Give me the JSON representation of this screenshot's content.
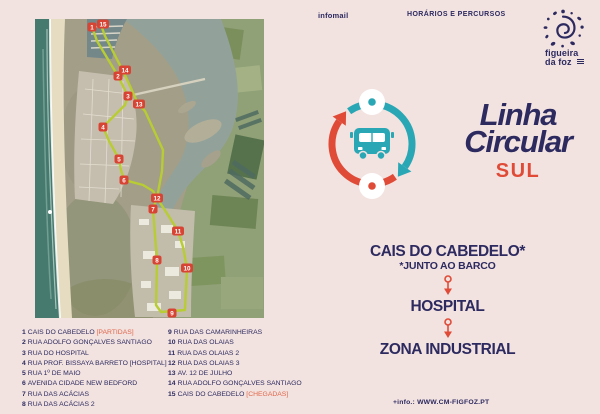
{
  "header": {
    "infomail_label": "infomail",
    "menu_label": "HORÁRIOS E PERCURSOS"
  },
  "municipality_logo": {
    "line1": "figueira",
    "line2": "da foz"
  },
  "title": {
    "line1": "Linha",
    "line2": "Circular",
    "line3": "SUL"
  },
  "route_summary": {
    "stops": [
      {
        "name": "CAIS DO CABEDELO*",
        "note": "*JUNTO AO BARCO"
      },
      {
        "name": "HOSPITAL",
        "note": ""
      },
      {
        "name": "ZONA INDUSTRIAL",
        "note": ""
      }
    ]
  },
  "map": {
    "markers": [
      {
        "n": "1",
        "x": 57,
        "y": 8
      },
      {
        "n": "15",
        "x": 68,
        "y": 5
      },
      {
        "n": "2",
        "x": 83,
        "y": 57
      },
      {
        "n": "14",
        "x": 90,
        "y": 51
      },
      {
        "n": "3",
        "x": 93,
        "y": 77
      },
      {
        "n": "13",
        "x": 104,
        "y": 85
      },
      {
        "n": "4",
        "x": 68,
        "y": 108
      },
      {
        "n": "5",
        "x": 84,
        "y": 140
      },
      {
        "n": "6",
        "x": 89,
        "y": 161
      },
      {
        "n": "7",
        "x": 118,
        "y": 190
      },
      {
        "n": "8",
        "x": 122,
        "y": 241
      },
      {
        "n": "9",
        "x": 137,
        "y": 294
      },
      {
        "n": "10",
        "x": 152,
        "y": 249
      },
      {
        "n": "11",
        "x": 143,
        "y": 212
      },
      {
        "n": "12",
        "x": 122,
        "y": 179
      }
    ]
  },
  "stops_list": {
    "col1": [
      {
        "num": "1",
        "name": "CAIS DO CABEDELO",
        "tag": "[PARTIDAS]"
      },
      {
        "num": "2",
        "name": "RUA ADOLFO GONÇALVES SANTIAGO"
      },
      {
        "num": "3",
        "name": "RUA DO HOSPITAL"
      },
      {
        "num": "4",
        "name": "RUA PROF. BISSAYA BARRETO [HOSPITAL]"
      },
      {
        "num": "5",
        "name": "RUA 1º DE MAIO"
      },
      {
        "num": "6",
        "name": "AVENIDA CIDADE NEW BEDFORD"
      },
      {
        "num": "7",
        "name": "RUA DAS ACÁCIAS"
      },
      {
        "num": "8",
        "name": "RUA DAS ACÁCIAS 2"
      }
    ],
    "col2": [
      {
        "num": "9",
        "name": "RUA DAS CAMARINHEIRAS"
      },
      {
        "num": "10",
        "name": "RUA DAS OLAIAS"
      },
      {
        "num": "11",
        "name": "RUA DAS OLAIAS 2"
      },
      {
        "num": "12",
        "name": "RUA DAS OLAIAS 3"
      },
      {
        "num": "13",
        "name": "AV. 12 DE JULHO"
      },
      {
        "num": "14",
        "name": "RUA ADOLFO GONÇALVES SANTIAGO"
      },
      {
        "num": "15",
        "name": "CAIS DO CABEDELO",
        "tag": "[CHEGADAS]"
      }
    ]
  },
  "footer": {
    "info_label": "+info.: WWW.CM-FIGFOZ.PT"
  },
  "colors": {
    "background": "#f2e3e0",
    "navy": "#2d2a60",
    "red": "#e04b38",
    "teal": "#2aa7b5",
    "route_lime": "#b8cc33",
    "marker_red": "#d84434"
  }
}
